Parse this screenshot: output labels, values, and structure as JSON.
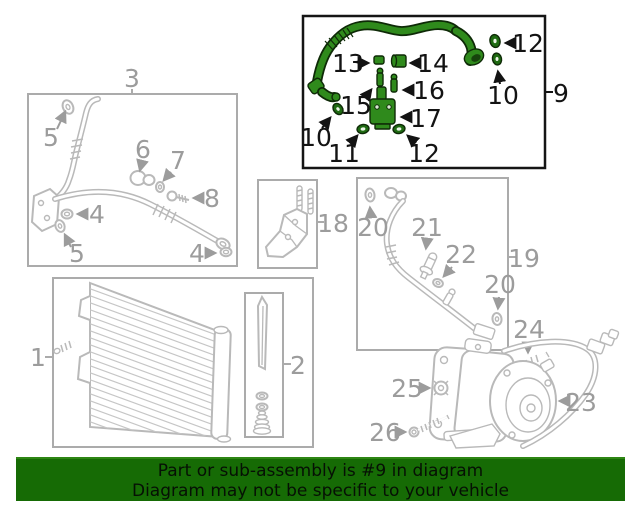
{
  "banner": {
    "line1": "Part or sub-assembly is #9 in diagram",
    "line2": "Diagram may not be specific to your vehicle",
    "background_color": "#166b05",
    "text_color": "#000000"
  },
  "colors": {
    "highlight_green_fill": "#2f8a1c",
    "highlight_green_dark": "#1f6b12",
    "highlight_outline": "#0e2a07",
    "gray_line": "#b9b9b9",
    "gray_label": "#9c9c9c",
    "box_border_gray": "#ababab",
    "box_border_black": "#151515"
  },
  "diagram": {
    "highlighted_box_label": "9",
    "labels": {
      "box1": "1",
      "box2": "2",
      "box3": "3",
      "box9": "9",
      "box18": "18",
      "box19": "19",
      "p4a": "4",
      "p4b": "4",
      "p5a": "5",
      "p5b": "5",
      "p6": "6",
      "p7": "7",
      "p8": "8",
      "p10a": "10",
      "p10b": "10",
      "p11": "11",
      "p12a": "12",
      "p12b": "12",
      "p13": "13",
      "p14": "14",
      "p15": "15",
      "p16": "16",
      "p17": "17",
      "p20a": "20",
      "p20b": "20",
      "p21": "21",
      "p22": "22",
      "p23": "23",
      "p24": "24",
      "p25": "25",
      "p26": "26"
    }
  }
}
